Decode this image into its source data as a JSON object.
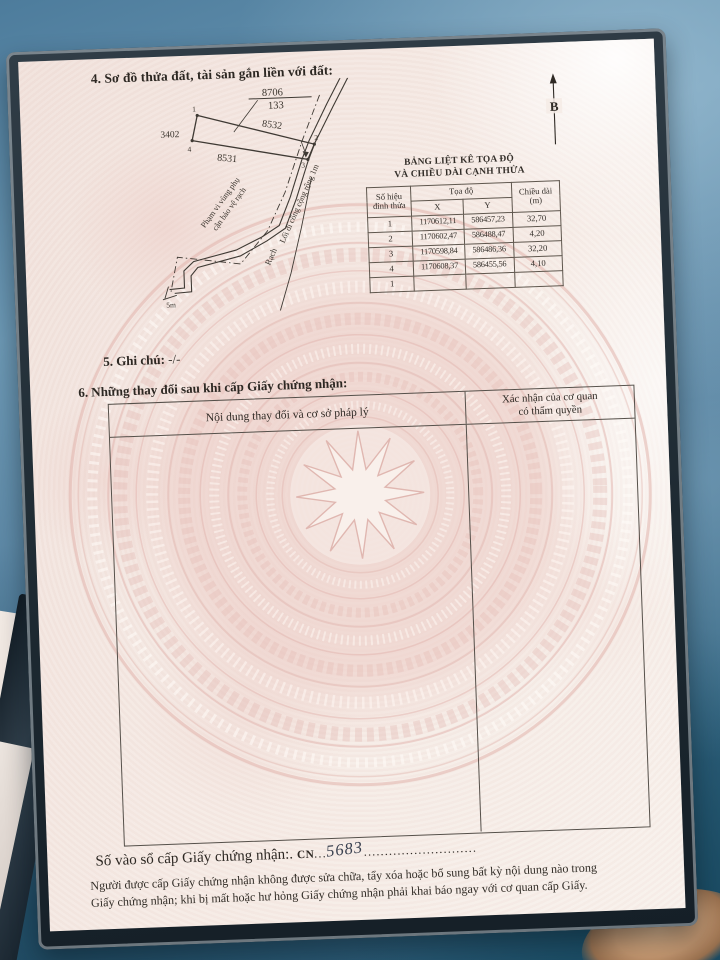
{
  "colors": {
    "fabric_blue": "#5d8aa8",
    "page_pink": "#f2dfd9",
    "watermark_pink": "#e4b8b1",
    "ink": "#2d2823",
    "handwriting_ink": "#3a4150"
  },
  "page": {
    "section4_title": "4. Sơ đồ thửa đất, tài sản gắn liền với đất:",
    "diagram": {
      "north_label": "B",
      "fraction_top": "8706",
      "fraction_bottom": "133",
      "parcel_left": "3402",
      "parcel_above": "8532",
      "parcel_below": "8531",
      "vertex_1": "1",
      "vertex_2": "2",
      "vertex_3": "3",
      "vertex_4": "4",
      "buffer_label_line1": "Phạm vi vùng phụ",
      "buffer_label_line2": "cận bảo vệ rạch",
      "path_label": "Lối đi công cộng rộng 1m",
      "canal_label": "Rạch",
      "width_label": "5m"
    },
    "coord_table": {
      "title_line1": "BẢNG LIỆT KÊ TỌA ĐỘ",
      "title_line2": "VÀ CHIỀU DÀI CẠNH THỬA",
      "header": {
        "no_line1": "Số hiệu",
        "no_line2": "đỉnh thửa",
        "group": "Tọa độ",
        "x": "X",
        "y": "Y",
        "len_line1": "Chiều dài",
        "len_line2": "(m)"
      },
      "rows": [
        {
          "id": "1",
          "x": "1170612,11",
          "y": "586457,23",
          "len": "32,70"
        },
        {
          "id": "2",
          "x": "1170602,47",
          "y": "586488,47",
          "len": "4,20"
        },
        {
          "id": "3",
          "x": "1170598,84",
          "y": "586486,36",
          "len": "32,20"
        },
        {
          "id": "4",
          "x": "1170608,37",
          "y": "586455,56",
          "len": "4,10"
        },
        {
          "id": "1",
          "x": "",
          "y": "",
          "len": ""
        }
      ]
    },
    "section5": {
      "label": "5. Ghi chú:",
      "value": "-/-"
    },
    "section6": {
      "title": "6. Những thay đổi sau khi cấp Giấy chứng nhận:",
      "col1_header": "Nội dung thay đổi và cơ sở pháp lý",
      "col2_header_line1": "Xác nhận của cơ quan",
      "col2_header_line2": "có thẩm quyền"
    },
    "serial": {
      "label": "Số vào sổ cấp Giấy chứng nhận:.",
      "prefix": "CN",
      "dots_before": "...",
      "number": "5683",
      "dots_after": "..........................."
    },
    "notes": {
      "line1": "Người được cấp Giấy chứng nhận không được sửa chữa, tẩy xóa hoặc bổ sung bất kỳ nội dung nào trong",
      "line2": "Giấy chứng nhận; khi bị mất hoặc hư hỏng Giấy chứng nhận phải khai báo ngay với cơ quan cấp Giấy."
    }
  }
}
